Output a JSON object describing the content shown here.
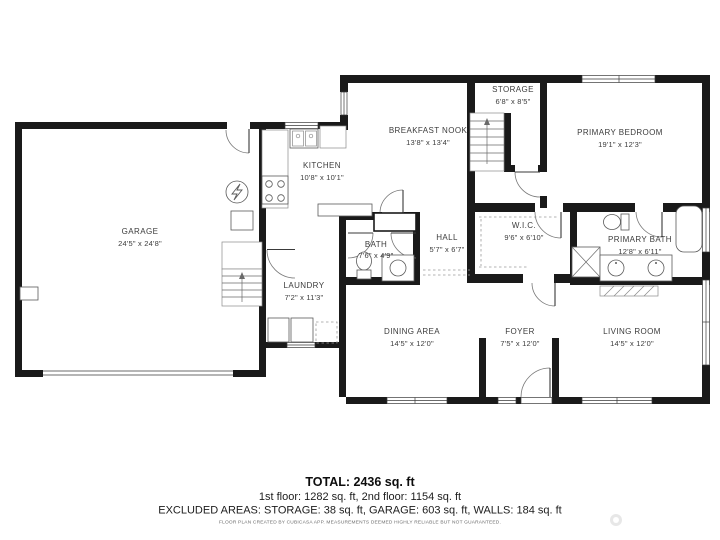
{
  "plan": {
    "wall_color": "#1a1a1a",
    "rooms": [
      {
        "name": "GARAGE",
        "dims": "24'5\" x 24'8\""
      },
      {
        "name": "KITCHEN",
        "dims": "10'8\" x 10'1\""
      },
      {
        "name": "BREAKFAST NOOK",
        "dims": "13'8\" x 13'4\""
      },
      {
        "name": "STORAGE",
        "dims": "6'8\" x 8'5\""
      },
      {
        "name": "PRIMARY BEDROOM",
        "dims": "19'1\" x 12'3\""
      },
      {
        "name": "LAUNDRY",
        "dims": "7'2\" x 11'3\""
      },
      {
        "name": "BATH",
        "dims": "7'6\" x 4'9\""
      },
      {
        "name": "HALL",
        "dims": "5'7\" x 6'7\""
      },
      {
        "name": "W.I.C.",
        "dims": "9'6\" x 6'10\""
      },
      {
        "name": "PRIMARY BATH",
        "dims": "12'8\" x 6'11\""
      },
      {
        "name": "DINING AREA",
        "dims": "14'5\" x 12'0\""
      },
      {
        "name": "FOYER",
        "dims": "7'5\" x 12'0\""
      },
      {
        "name": "LIVING ROOM",
        "dims": "14'5\" x 12'0\""
      }
    ]
  },
  "footer": {
    "total": "TOTAL: 2436 sq. ft",
    "floors": "1st floor: 1282 sq. ft, 2nd floor: 1154 sq. ft",
    "excluded": "EXCLUDED AREAS: STORAGE: 38 sq. ft, GARAGE: 603 sq. ft, WALLS: 184 sq. ft",
    "disclaimer": "FLOOR PLAN CREATED BY CUBICASA APP. MEASUREMENTS DEEMED HIGHLY RELIABLE BUT NOT GUARANTEED."
  }
}
